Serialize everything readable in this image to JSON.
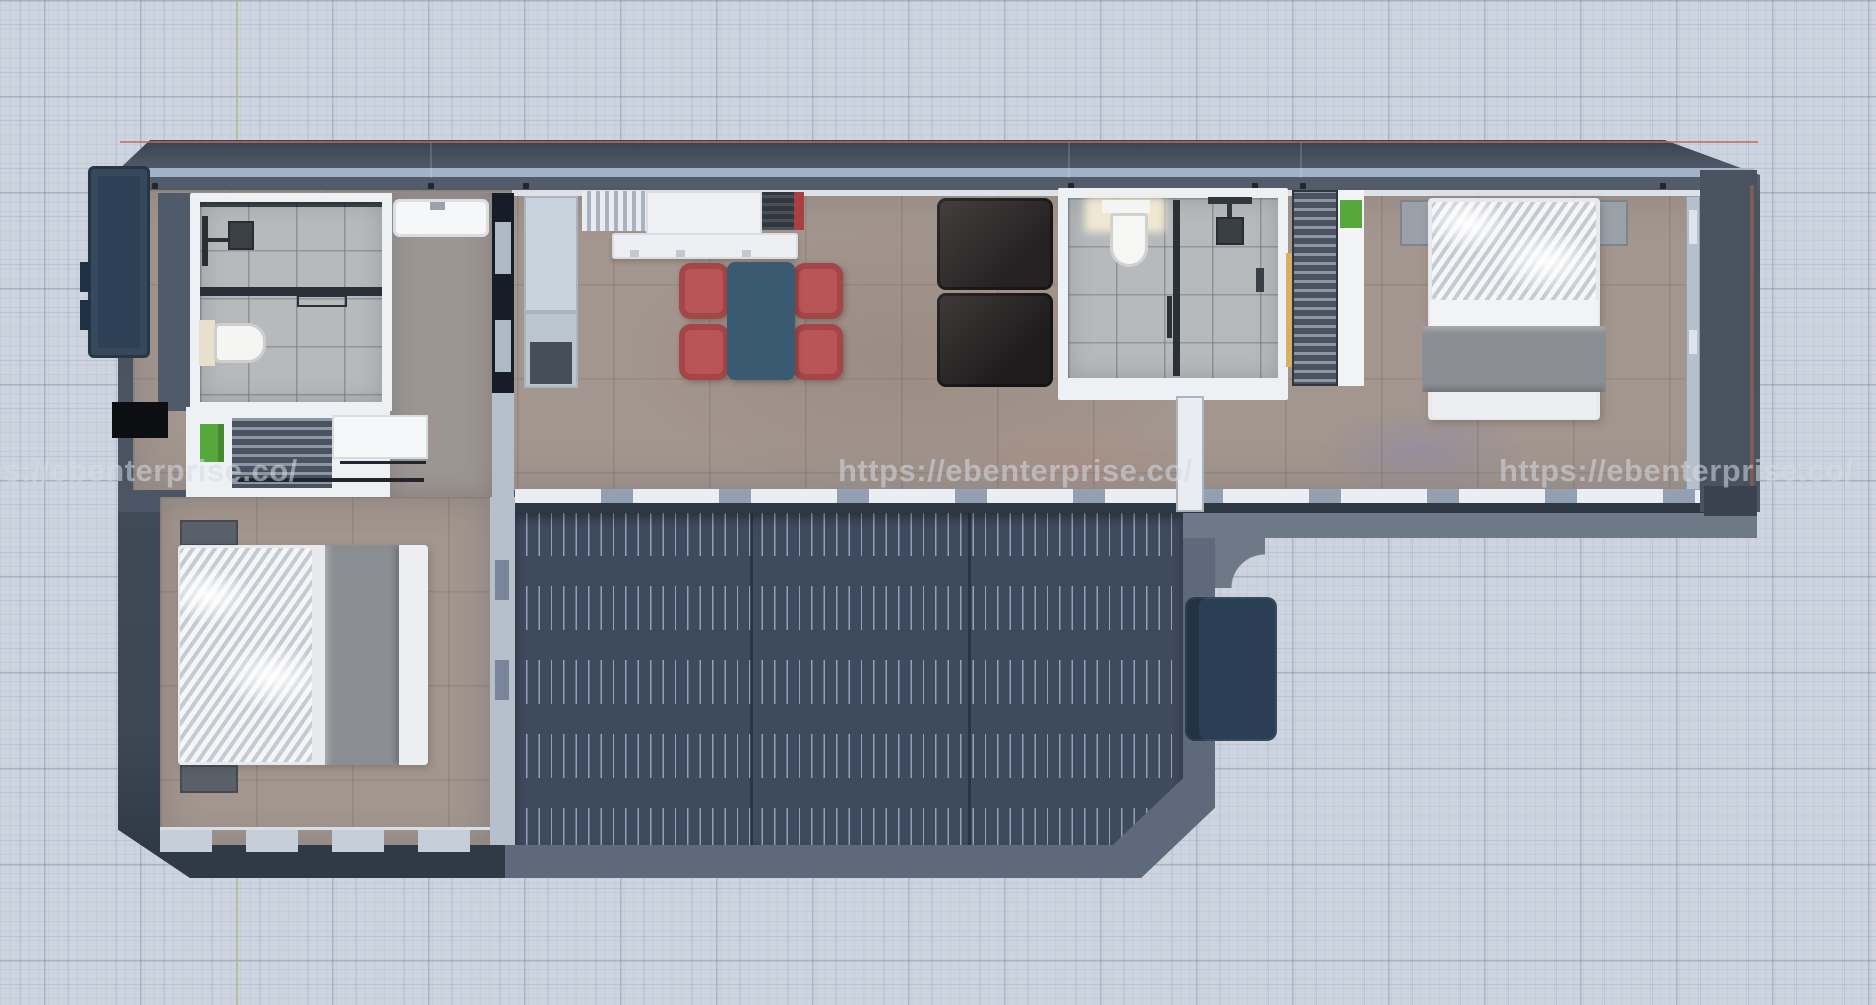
{
  "scene": {
    "type": "3d-floor-plan-top-view",
    "subject": "container home floor plan render",
    "background": "cad-grid"
  },
  "watermark": {
    "text": "https://ebenterprise.co/"
  },
  "colors": {
    "bg": "#cdd4e0",
    "roof": "#4b5563",
    "roof-accent": "#a7b8cc",
    "wall-white": "#eef1f4",
    "navy": "#2d4156",
    "tile": "#b7babc",
    "floor": "#a3968e",
    "floor2": "#9d9591",
    "deck": "#3e4a5d",
    "deck-line": "#93a2b8",
    "deck-border": "#5e6a7b",
    "walkway": "#6e7987",
    "sofa": "#332f30",
    "chair": "#b95457",
    "table": "#3a5a72",
    "blanket": "#8b8e92",
    "bedwhite": "#e7e9ec",
    "green": "#57a83c",
    "stairs": "#2b3f54",
    "watermark": "rgba(214,219,228,0.55)",
    "axis-green": "#b7c46e",
    "axis-red": "#c2685c"
  },
  "rooms": [
    "bathroom-1",
    "hallway",
    "kitchen",
    "dining-area",
    "living-area",
    "bathroom-2",
    "bedroom-1",
    "bedroom-2",
    "deck"
  ],
  "furniture": [
    "shower-fixture",
    "glass-partition",
    "toilet",
    "sink-vanity",
    "storage-cabinet",
    "refrigerator",
    "vent-grille",
    "cooktop",
    "kitchen-island",
    "dining-table",
    "dining-chairs-red-x4",
    "sofa-dark",
    "louver-wardrobe",
    "linen-cabinet",
    "double-bed-x2",
    "nightstands",
    "deck-stairs",
    "exterior-door-panel"
  ]
}
